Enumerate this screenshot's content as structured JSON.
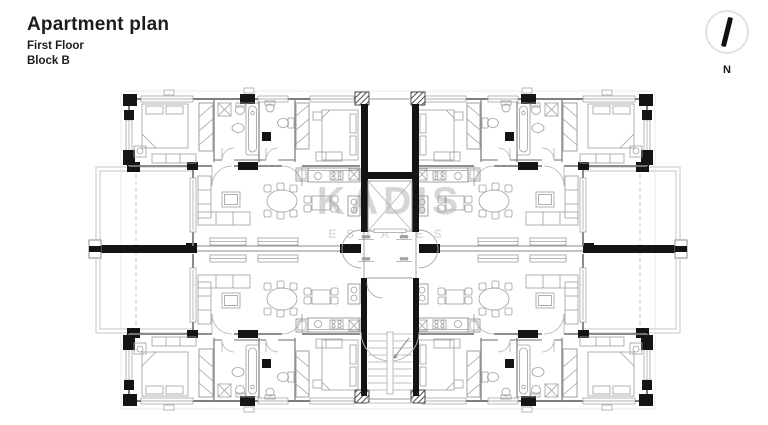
{
  "header": {
    "title": "Apartment plan",
    "floor": "First Floor",
    "block": "Block B"
  },
  "compass": {
    "label": "N"
  },
  "watermark": {
    "name": "KADIS",
    "tagline": "ESTATES"
  },
  "plan": {
    "dimension_labels": {
      "d1": "1038",
      "d2": "1058",
      "d3": "1028",
      "d4": "1048"
    }
  },
  "colors": {
    "structure_black": "#141414",
    "wall_gray": "#7e7e7e",
    "furniture_gray": "#9e9e9e",
    "terrace_gray": "#c6c6c6",
    "watermark_gray": "#d6d6d6",
    "text_dark": "#1c1c1c"
  }
}
